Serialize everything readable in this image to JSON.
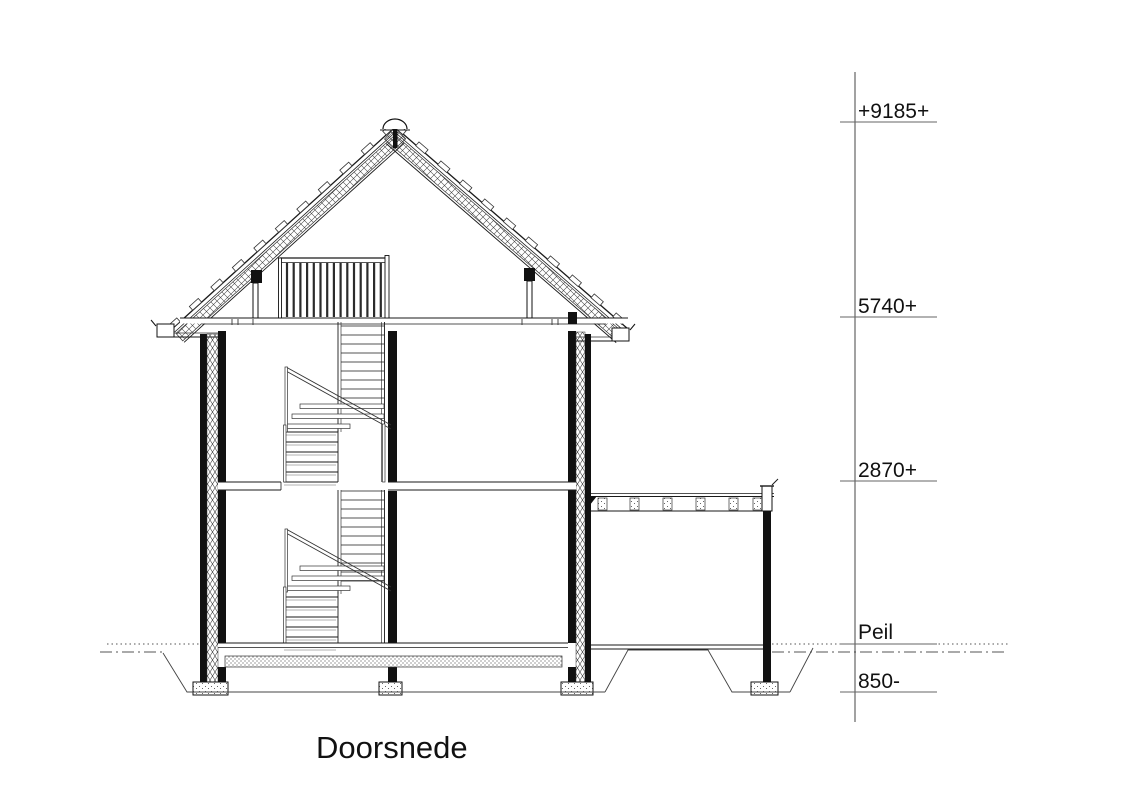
{
  "drawing": {
    "title": "Doorsnede",
    "elevation_markers": [
      {
        "label": "+9185+"
      },
      {
        "label": "5740+"
      },
      {
        "label": "2870+"
      },
      {
        "label": "Peil"
      },
      {
        "label": "850-"
      }
    ],
    "colors": {
      "background": "#ffffff",
      "line": "#1a1a1a",
      "wall_fill": "#111111"
    }
  }
}
